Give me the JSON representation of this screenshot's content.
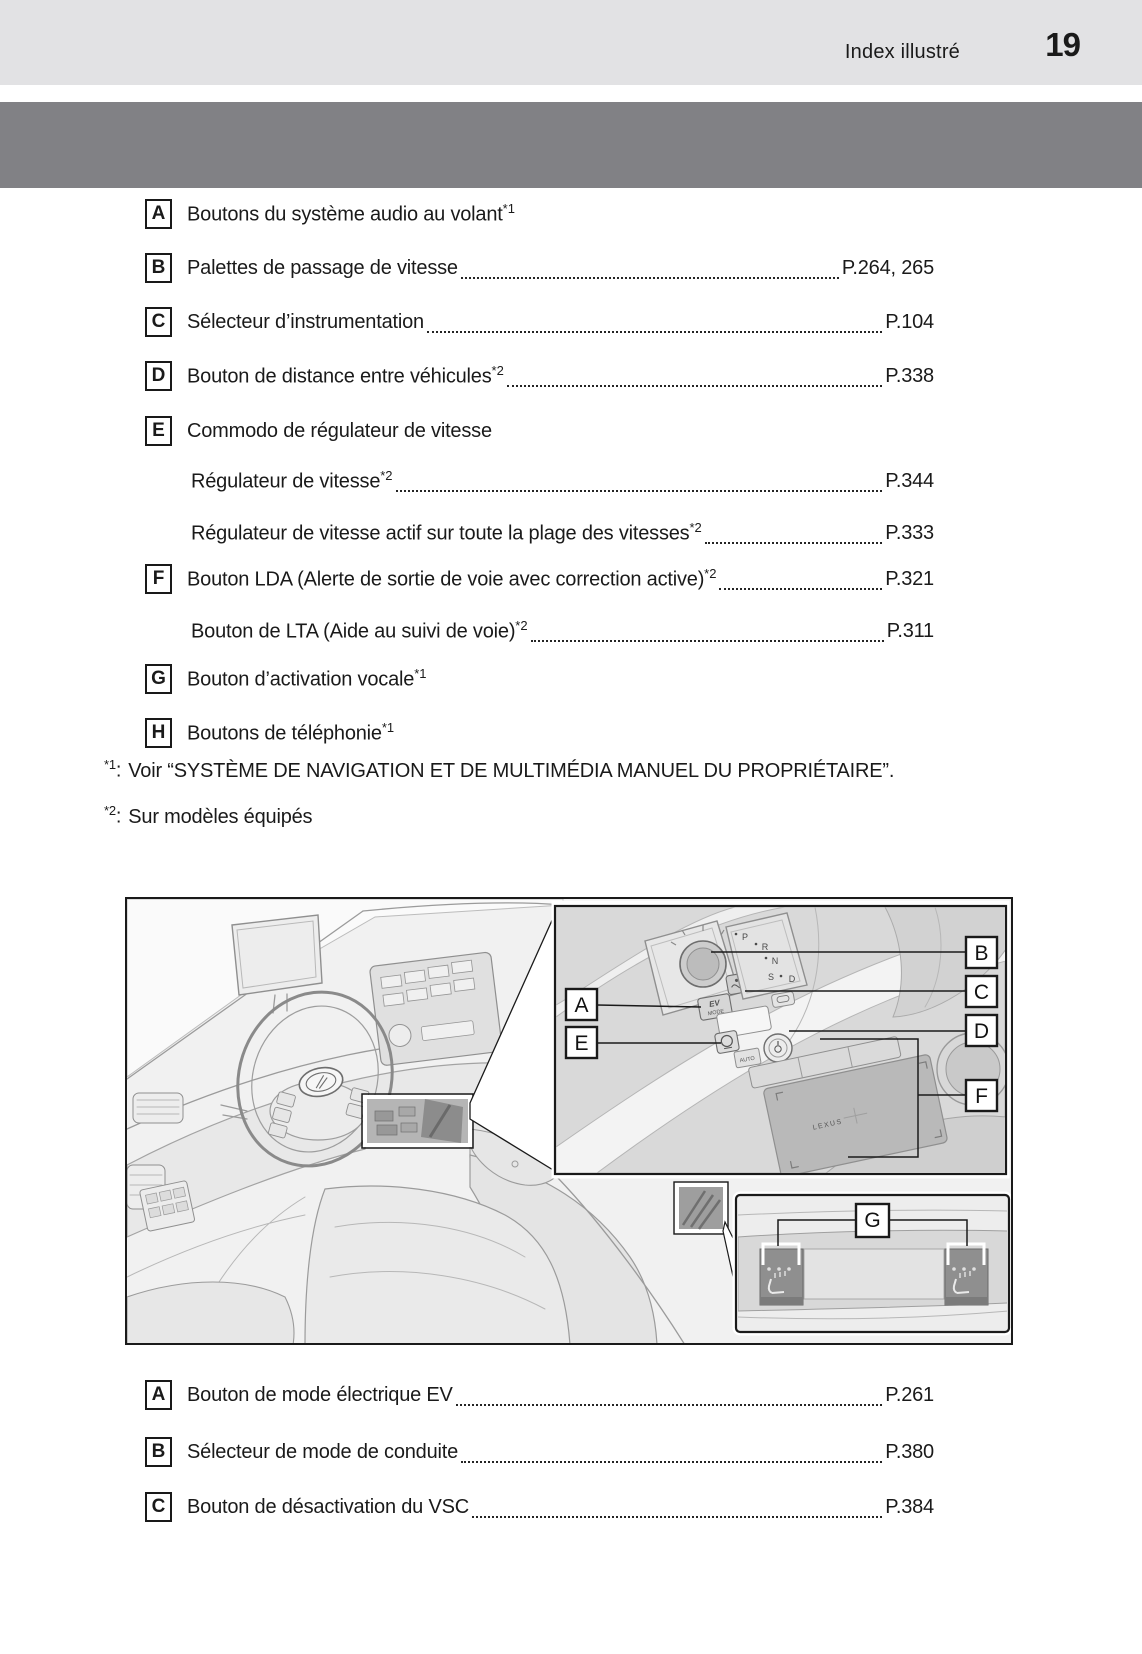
{
  "header": {
    "section_title": "Index illustré",
    "page_number": "19"
  },
  "top_list": {
    "items": [
      {
        "letter": "A",
        "text": "Boutons du système audio au volant",
        "sup": "*1",
        "page": ""
      },
      {
        "letter": "B",
        "text": "Palettes de passage de vitesse",
        "sup": "",
        "page": "P.264, 265"
      },
      {
        "letter": "C",
        "text": "Sélecteur d’instrumentation ",
        "sup": "",
        "page": "P.104"
      },
      {
        "letter": "D",
        "text": "Bouton de distance entre véhicules",
        "sup": "*2",
        "page": "P.338"
      },
      {
        "letter": "E",
        "text": "Commodo de régulateur de vitesse",
        "sup": "",
        "page": ""
      },
      {
        "letter": "",
        "text": "Régulateur de vitesse",
        "sup": "*2",
        "page": "P.344"
      },
      {
        "letter": "",
        "text": "Régulateur de vitesse actif sur toute la plage des vitesses",
        "sup": "*2",
        "page": "P.333"
      },
      {
        "letter": "F",
        "text": "Bouton LDA (Alerte de sortie de voie avec correction active)",
        "sup": "*2",
        "page": "P.321"
      },
      {
        "letter": "",
        "text": "Bouton de LTA (Aide au suivi de voie)",
        "sup": "*2",
        "page": "P.311"
      },
      {
        "letter": "G",
        "text": "Bouton d’activation vocale",
        "sup": "*1",
        "page": ""
      },
      {
        "letter": "H",
        "text": "Boutons de téléphonie",
        "sup": "*1",
        "page": ""
      }
    ]
  },
  "footnotes": [
    {
      "marker": "*1",
      "colon": ":",
      "text": "Voir “SYSTÈME DE NAVIGATION ET DE MULTIMÉDIA MANUEL DU PROPRIÉTAIRE”."
    },
    {
      "marker": "*2",
      "colon": ":",
      "text": "Sur modèles équipés"
    }
  ],
  "illustration": {
    "callouts": [
      "A",
      "B",
      "C",
      "D",
      "E",
      "F",
      "G"
    ],
    "console": {
      "ev": "EV",
      "mode": "MODE",
      "auto": "AUTO",
      "brand": "LEXUS"
    },
    "shift_letters": [
      "P",
      "R",
      "N",
      "S",
      "D"
    ]
  },
  "bottom_list": {
    "items": [
      {
        "letter": "A",
        "text": "Bouton de mode électrique EV ",
        "page": "P.261"
      },
      {
        "letter": "B",
        "text": "Sélecteur de mode de conduite",
        "page": "P.380"
      },
      {
        "letter": "C",
        "text": "Bouton de désactivation du VSC",
        "page": "P.384"
      }
    ]
  },
  "colors": {
    "band_light": "#e2e2e4",
    "band_dark": "#818185",
    "text": "#1a1a1a",
    "sketch_bg": "#f1f1f1"
  }
}
